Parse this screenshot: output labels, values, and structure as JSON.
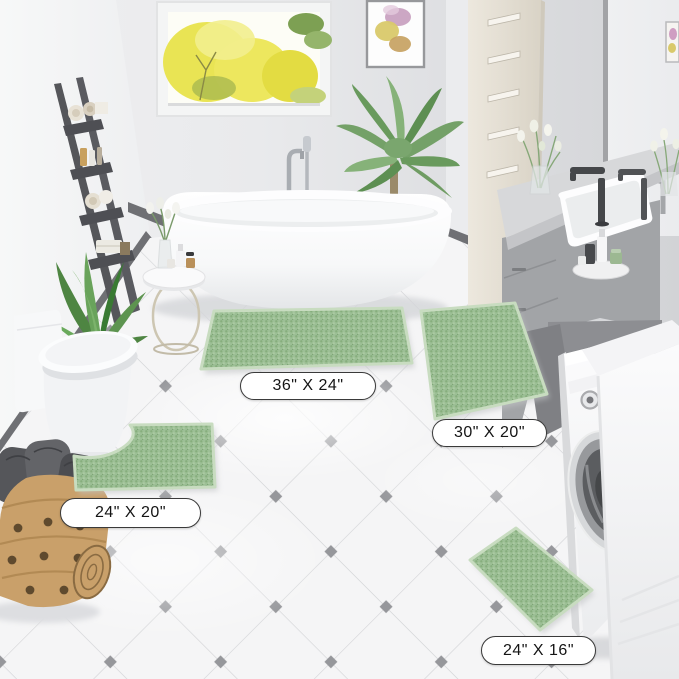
{
  "image_type": "product-lifestyle-photo",
  "labels": {
    "rug_36x24": "36\" X 24\"",
    "rug_30x20": "30\" X 20\"",
    "rug_24x20": "24\" X 20\"",
    "rug_24x16": "24\" X 16\""
  },
  "colors": {
    "rug_green": "#9CBF95",
    "rug_green_dark": "#87AE7D",
    "rug_green_light": "#ACCBA3",
    "rug_edge": "#C8DCC0",
    "wall_gray": "#D9DADC",
    "wall_white": "#F3F4F5",
    "floor_white": "#F5F5F6",
    "tile_line": "#D2D3D6",
    "tile_accent_gray": "#96979B",
    "baseboard_gray": "#6F7074",
    "ladder_gray": "#55565A",
    "vanity_gray": "#A2A4A7",
    "counter_gray": "#D7D8DA",
    "faucet_dark": "#45474A",
    "basket_tan": "#C9A06A",
    "window_foliage_yellow": "#E8E34B",
    "label_border": "#3A3A3A",
    "label_text": "#141414"
  },
  "scene_objects": [
    "window-with-yellow-trees",
    "framed-wall-art",
    "ladder-shelf-with-towels",
    "potted-plant",
    "toilet",
    "woven-laundry-basket",
    "freestanding-bathtub",
    "floor-mounted-tub-faucet",
    "round-side-table-with-toiletries",
    "palm-plant",
    "tall-beige-cabinet",
    "gray-vanity-with-sink",
    "vanity-mirror",
    "flower-vase",
    "toiletry-tray",
    "washing-machine",
    "white-laundry-cabinet",
    "green-chenille-rug-36x24",
    "green-chenille-rug-30x20",
    "green-contour-rug-24x20",
    "green-chenille-rug-24x16"
  ]
}
